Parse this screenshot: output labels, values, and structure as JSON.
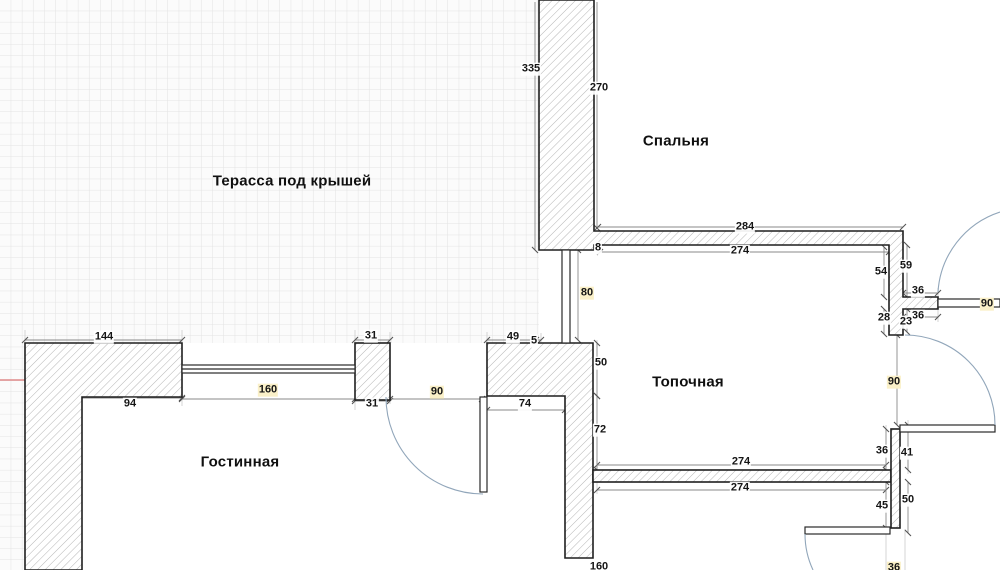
{
  "rooms": {
    "terrace": "Терасса под крышей",
    "bedroom": "Спальня",
    "boiler": "Топочная",
    "living": "Гостинная"
  },
  "dims": {
    "terrace_wall_335": "335",
    "bedroom_left_270": "270",
    "bedroom_bottom_outer_284": "284",
    "bedroom_bottom_inner_274": "274",
    "partition_8": "8",
    "right_59": "59",
    "right_54": "54",
    "right_sill_top_36": "36",
    "right_door_top_90": "90",
    "right_sill_bottom_36": "36",
    "right_28": "28",
    "right_23": "23",
    "terrace_front_144": "144",
    "pier_top_31": "31",
    "block_top_49": "49",
    "block_top_5": "5",
    "window_160": "160",
    "living_top_94": "94",
    "pier_bottom_31": "31",
    "living_door_90": "90",
    "block_bottom_74": "74",
    "boiler_left_50": "50",
    "boiler_left_80": "80",
    "boiler_left_72": "72",
    "boiler_bottom_upper_274": "274",
    "boiler_bottom_lower_274": "274",
    "right_wall_36": "36",
    "right_wall_41": "41",
    "right_door_mid_90": "90",
    "right_wall_45": "45",
    "right_wall_50": "50",
    "bottom_160": "160",
    "bottom_36": "36"
  },
  "colors": {
    "wall_outline": "#1f1f1f",
    "hatch": "#b5b5b5",
    "dim_line": "#8a8a8a",
    "door_arc": "#91a6ba",
    "grid": "#e3e3e3",
    "highlight": "#faf0c8",
    "marker_red": "#e08a8a"
  }
}
